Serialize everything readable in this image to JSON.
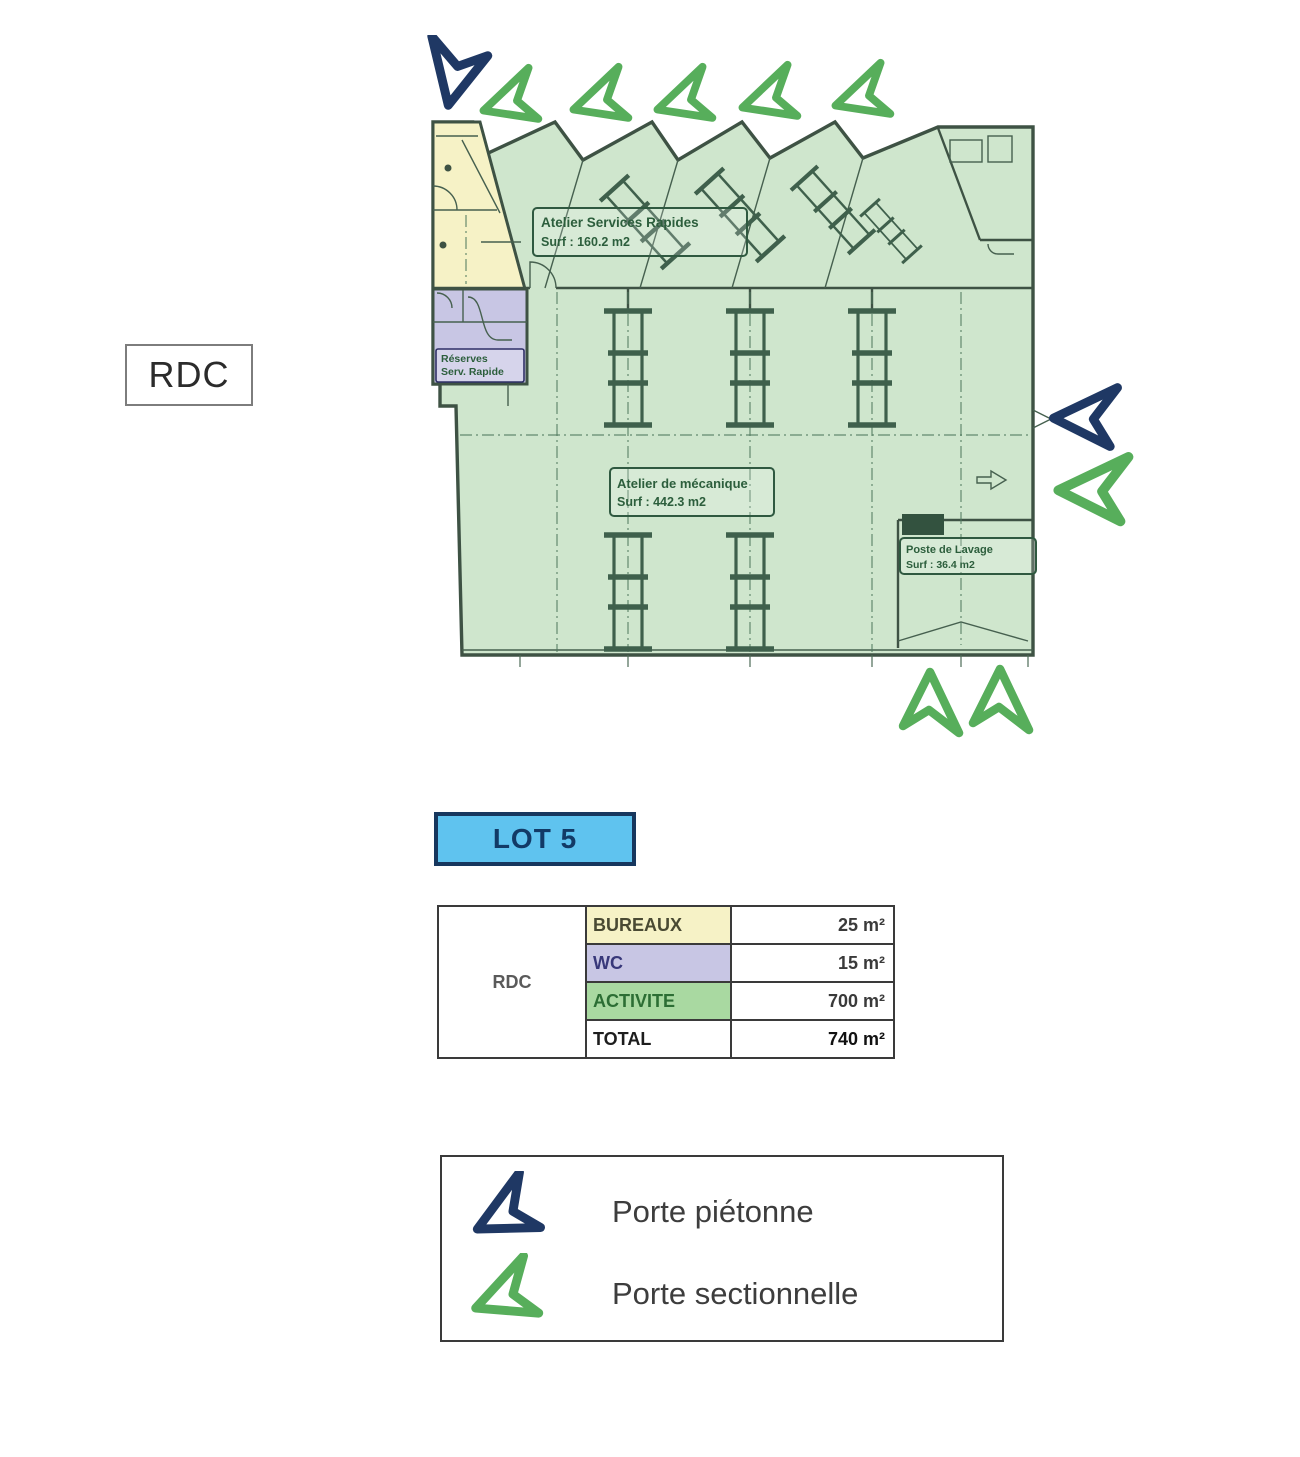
{
  "page": {
    "floor_box_label": "RDC"
  },
  "plan": {
    "rooms": {
      "atelier_services": {
        "name": "Atelier Services Rapides",
        "surface": "Surf : 160.2 m2"
      },
      "atelier_mecanique": {
        "name": "Atelier de mécanique",
        "surface": "Surf : 442.3 m2"
      },
      "poste_lavage": {
        "name": "Poste de Lavage",
        "surface": "Surf : 36.4 m2"
      },
      "reserves": {
        "line1": "Réserves",
        "line2": "Serv. Rapide"
      }
    },
    "colors": {
      "activity_fill": "#cfe6cd",
      "bureaux_fill": "#f6f2c6",
      "wc_fill": "#c8c6e4",
      "outline": "#3e5244",
      "pedestrian_arrow": "#1f3864",
      "sectional_arrow": "#57ae5b"
    }
  },
  "lot": {
    "label": "LOT 5",
    "fill": "#5fc3ef",
    "border": "#17375e"
  },
  "table": {
    "floor": "RDC",
    "rows": [
      {
        "label": "BUREAUX",
        "value": "25 m²",
        "fill": "#f6f2c6"
      },
      {
        "label": "WC",
        "value": "15 m²",
        "fill": "#c8c6e4"
      },
      {
        "label": "ACTIVITE",
        "value": "700 m²",
        "fill": "#a9d9a1"
      },
      {
        "label": "TOTAL",
        "value": "740 m²",
        "fill": "#ffffff"
      }
    ]
  },
  "legend": {
    "items": [
      {
        "icon": "pedestrian-door-arrow",
        "label": "Porte piétonne"
      },
      {
        "icon": "sectional-door-arrow",
        "label": "Porte sectionnelle"
      }
    ]
  }
}
